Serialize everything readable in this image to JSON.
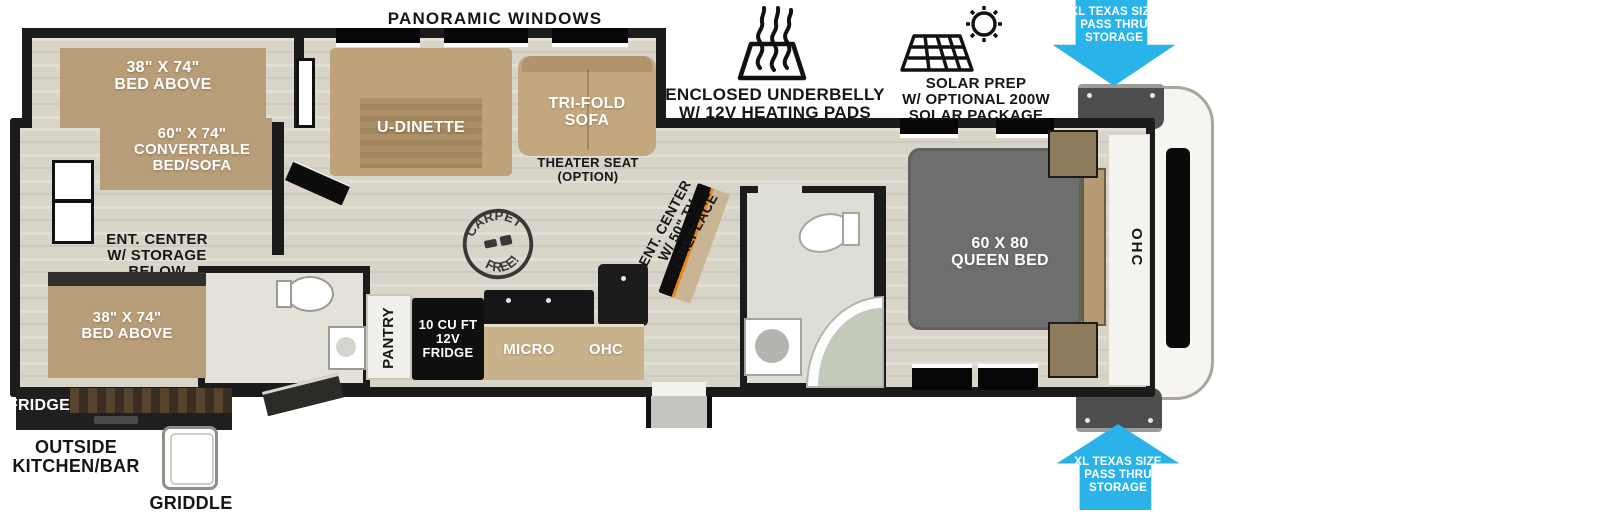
{
  "colors": {
    "accent_blue": "#2AB3E8",
    "wall_black": "#1B1B1B",
    "floor_beige": "#D8D4C8",
    "furniture_tan": "#B89E78",
    "queen_bed_gray": "#6E6E6E"
  },
  "top_annotations": {
    "panoramic_windows": "PANORAMIC WINDOWS",
    "underbelly": {
      "line1": "ENCLOSED UNDERBELLY",
      "line2": "W/ 12V HEATING PADS"
    },
    "solar": {
      "line1": "SOLAR PREP",
      "line2": "W/ OPTIONAL 200W",
      "line3": "SOLAR PACKAGE"
    },
    "pass_thru_top": {
      "line1": "XL TEXAS SIZE",
      "line2": "PASS THRU",
      "line3": "STORAGE"
    },
    "pass_thru_bottom": {
      "line1": "XL TEXAS SIZE",
      "line2": "PASS THRU",
      "line3": "STORAGE"
    }
  },
  "rear_section": {
    "bunk_top": {
      "line1": "38\" X 74\"",
      "line2": "BED ABOVE"
    },
    "convertible_bed": {
      "line1": "60\" X 74\"",
      "line2": "CONVERTABLE",
      "line3": "BED/SOFA"
    },
    "ent_center": {
      "line1": "ENT. CENTER",
      "line2": "W/ STORAGE",
      "line3": "BELOW"
    },
    "bunk_bottom": {
      "line1": "38\" X 74\"",
      "line2": "BED ABOVE"
    }
  },
  "living_area": {
    "u_dinette": "U-DINETTE",
    "tri_fold_sofa": {
      "line1": "TRI-FOLD",
      "line2": "SOFA"
    },
    "theater_seat": {
      "line1": "THEATER SEAT",
      "line2": "(OPTION)"
    },
    "ent_center": {
      "line1": "ENT. CENTER",
      "line2": "W/ 50\" TV",
      "line3": "& FIREPLACE"
    },
    "carpet_free_stamp": {
      "top": "CARPET",
      "bottom": "FREE!"
    }
  },
  "kitchen": {
    "pantry": "PANTRY",
    "fridge": {
      "line1": "10 CU FT",
      "line2": "12V",
      "line3": "FRIDGE"
    },
    "micro": "MICRO",
    "ohc": "OHC"
  },
  "bedroom": {
    "queen_bed": {
      "line1": "60 X 80",
      "line2": "QUEEN BED"
    },
    "ohc": "OHC"
  },
  "exterior": {
    "fridge": "FRIDGE",
    "outside_kitchen": {
      "line1": "OUTSIDE",
      "line2": "KITCHEN/BAR"
    },
    "griddle": "GRIDDLE"
  }
}
